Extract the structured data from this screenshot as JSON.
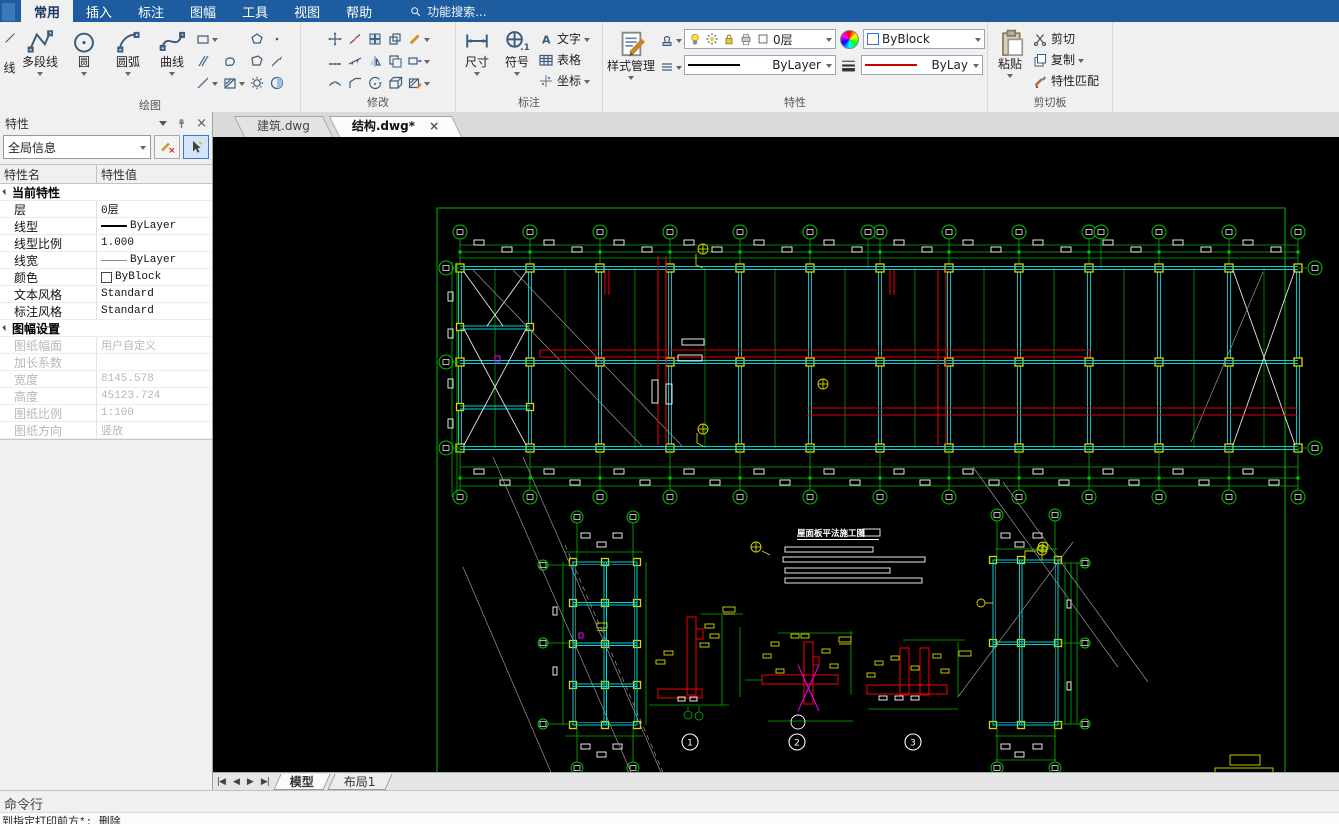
{
  "ribbon": {
    "tabs": [
      "常用",
      "插入",
      "标注",
      "图幅",
      "工具",
      "视图",
      "帮助"
    ],
    "active_tab": "常用",
    "search_text": "功能搜索...",
    "panels": {
      "draw": {
        "label": "绘图",
        "partial_button": "线",
        "big_buttons": [
          "多段线",
          "圆",
          "圆弧",
          "曲线"
        ]
      },
      "modify": {
        "label": "修改"
      },
      "dimension": {
        "label": "标注",
        "big_buttons": [
          "尺寸",
          "符号"
        ],
        "small_buttons": [
          "文字",
          "表格",
          "坐标"
        ]
      },
      "properties": {
        "label": "特性",
        "style_manager": "样式管理",
        "layer_value": "0层",
        "color_value": "ByBlock",
        "linetype_value": "ByLayer",
        "lineweight_value": "ByLay"
      },
      "clipboard": {
        "label": "剪切板",
        "paste": "粘贴",
        "cut": "剪切",
        "copy": "复制",
        "match": "特性匹配"
      }
    }
  },
  "document_tabs": {
    "tab1": "建筑.dwg",
    "tab2": "结构.dwg*"
  },
  "properties_panel": {
    "title": "特性",
    "selector_value": "全局信息",
    "columns": {
      "name": "特性名",
      "value": "特性值"
    },
    "group1": {
      "label": "当前特性",
      "rows": [
        {
          "name": "层",
          "value": "0层"
        },
        {
          "name": "线型",
          "value": "ByLayer"
        },
        {
          "name": "线型比例",
          "value": "1.000"
        },
        {
          "name": "线宽",
          "value": "ByLayer"
        },
        {
          "name": "颜色",
          "value": "ByBlock"
        },
        {
          "name": "文本风格",
          "value": "Standard"
        },
        {
          "name": "标注风格",
          "value": "Standard"
        }
      ]
    },
    "group2": {
      "label": "图幅设置",
      "rows": [
        {
          "name": "图纸幅面",
          "value": "用户自定义"
        },
        {
          "name": "加长系数",
          "value": ""
        },
        {
          "name": "宽度",
          "value": "8145.578"
        },
        {
          "name": "高度",
          "value": "45123.724"
        },
        {
          "name": "图纸比例",
          "value": "1:100"
        },
        {
          "name": "图纸方向",
          "value": "竖放"
        }
      ]
    }
  },
  "canvas": {
    "drawing_title": "屋面板平法施工图",
    "detail_bubbles": [
      "1",
      "2",
      "3"
    ]
  },
  "status": {
    "model_tab": "模型",
    "layout_tab": "布局1",
    "command_label": "命令行",
    "command_echo": "到指定打印前方*:  删除"
  },
  "icons": {
    "close": "×",
    "nav_first": "|◀",
    "nav_prev": "◀",
    "nav_next": "▶",
    "nav_last": "▶|"
  },
  "colors": {
    "accent_blue": "#1d5c9e",
    "cad_green": "#00b400",
    "cad_cyan": "#00d5d5",
    "cad_yellow": "#d8d800",
    "cad_red": "#e00000",
    "cad_magenta": "#f000f0",
    "canvas_bg": "#000000"
  }
}
